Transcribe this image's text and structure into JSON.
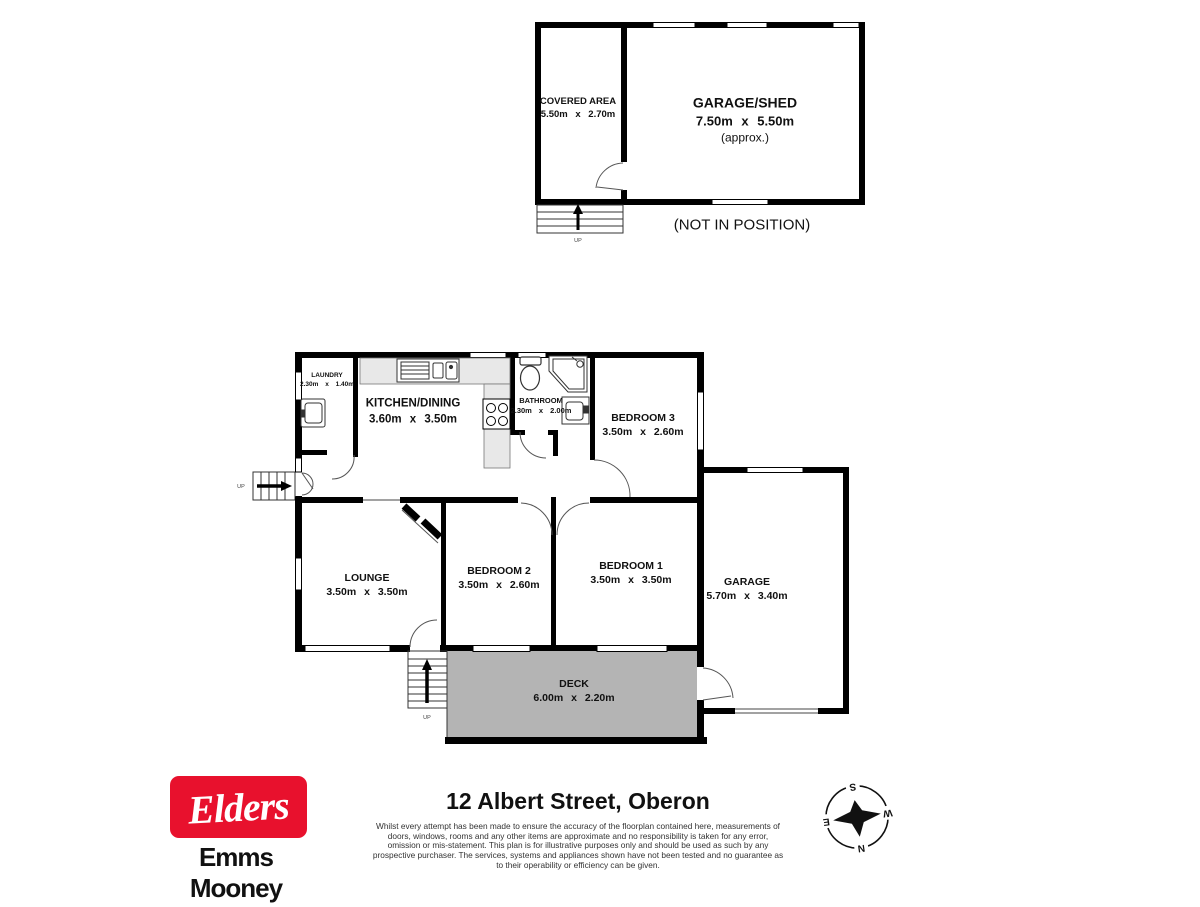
{
  "plan": {
    "outbuilding": {
      "covered_area": {
        "name": "COVERED AREA",
        "dims": "5.50m x 2.70m"
      },
      "garage_shed": {
        "name": "GARAGE/SHED",
        "dims": "7.50m x 5.50m",
        "note": "(approx.)"
      },
      "caption": "(NOT IN POSITION)"
    },
    "rooms": {
      "laundry": {
        "name": "LAUNDRY",
        "dims": "2.30m x 1.40m"
      },
      "kitchen_dining": {
        "name": "KITCHEN/DINING",
        "dims": "3.60m x 3.50m"
      },
      "bathroom": {
        "name": "BATHROOM",
        "dims": "2.30m x 2.00m"
      },
      "bedroom3": {
        "name": "BEDROOM 3",
        "dims": "3.50m x 2.60m"
      },
      "lounge": {
        "name": "LOUNGE",
        "dims": "3.50m x 3.50m"
      },
      "bedroom2": {
        "name": "BEDROOM 2",
        "dims": "3.50m x 2.60m"
      },
      "bedroom1": {
        "name": "BEDROOM 1",
        "dims": "3.50m x 3.50m"
      },
      "garage": {
        "name": "GARAGE",
        "dims": "5.70m x 3.40m"
      },
      "deck": {
        "name": "DECK",
        "dims": "6.00m x 2.20m"
      }
    },
    "stair_label": "UP",
    "colors": {
      "wall": "#000000",
      "deck_fill": "#b4b4b4",
      "counter_fill": "#e8e8e8"
    }
  },
  "compass": {
    "n": "N",
    "s": "S",
    "e": "E",
    "w": "W"
  },
  "footer": {
    "logo_text": "Elders",
    "agency_name": "Emms Mooney",
    "brand_red": "#e8112d",
    "title": "12 Albert Street, Oberon",
    "disclaimer": "Whilst every attempt has been made to ensure the accuracy of the floorplan contained here, measurements of doors, windows, rooms and any other items are approximate and no responsibility is taken for any error, omission or mis-statement. This plan is for illustrative purposes only and should be used as such by any prospective purchaser. The services, systems and appliances shown have not been tested and no guarantee as to their operability or efficiency can be given."
  }
}
